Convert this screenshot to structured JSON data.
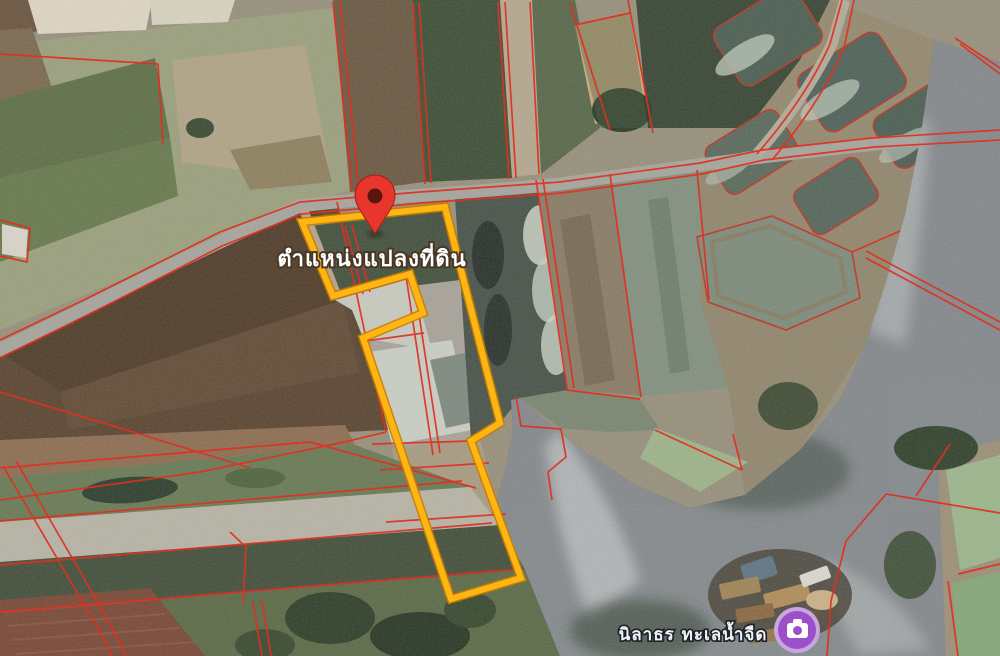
{
  "map": {
    "type": "satellite-imagery-with-cadastral-overlay",
    "plot_marker": {
      "label": "ตำแหน่งแปลงที่ดิน",
      "pin_icon": "location-pin-icon",
      "pin_color": "#E8362C",
      "plot_outline_color": "#FFB612"
    },
    "poi": {
      "label": "นิลาธร ทะเลน้ำจืด",
      "icon": "camera-icon",
      "icon_bg_color": "#9B4FC8"
    },
    "overlay": {
      "parcel_line_color": "#E03020",
      "water_color": "#22272e",
      "road_color": "#A6A59D"
    }
  }
}
